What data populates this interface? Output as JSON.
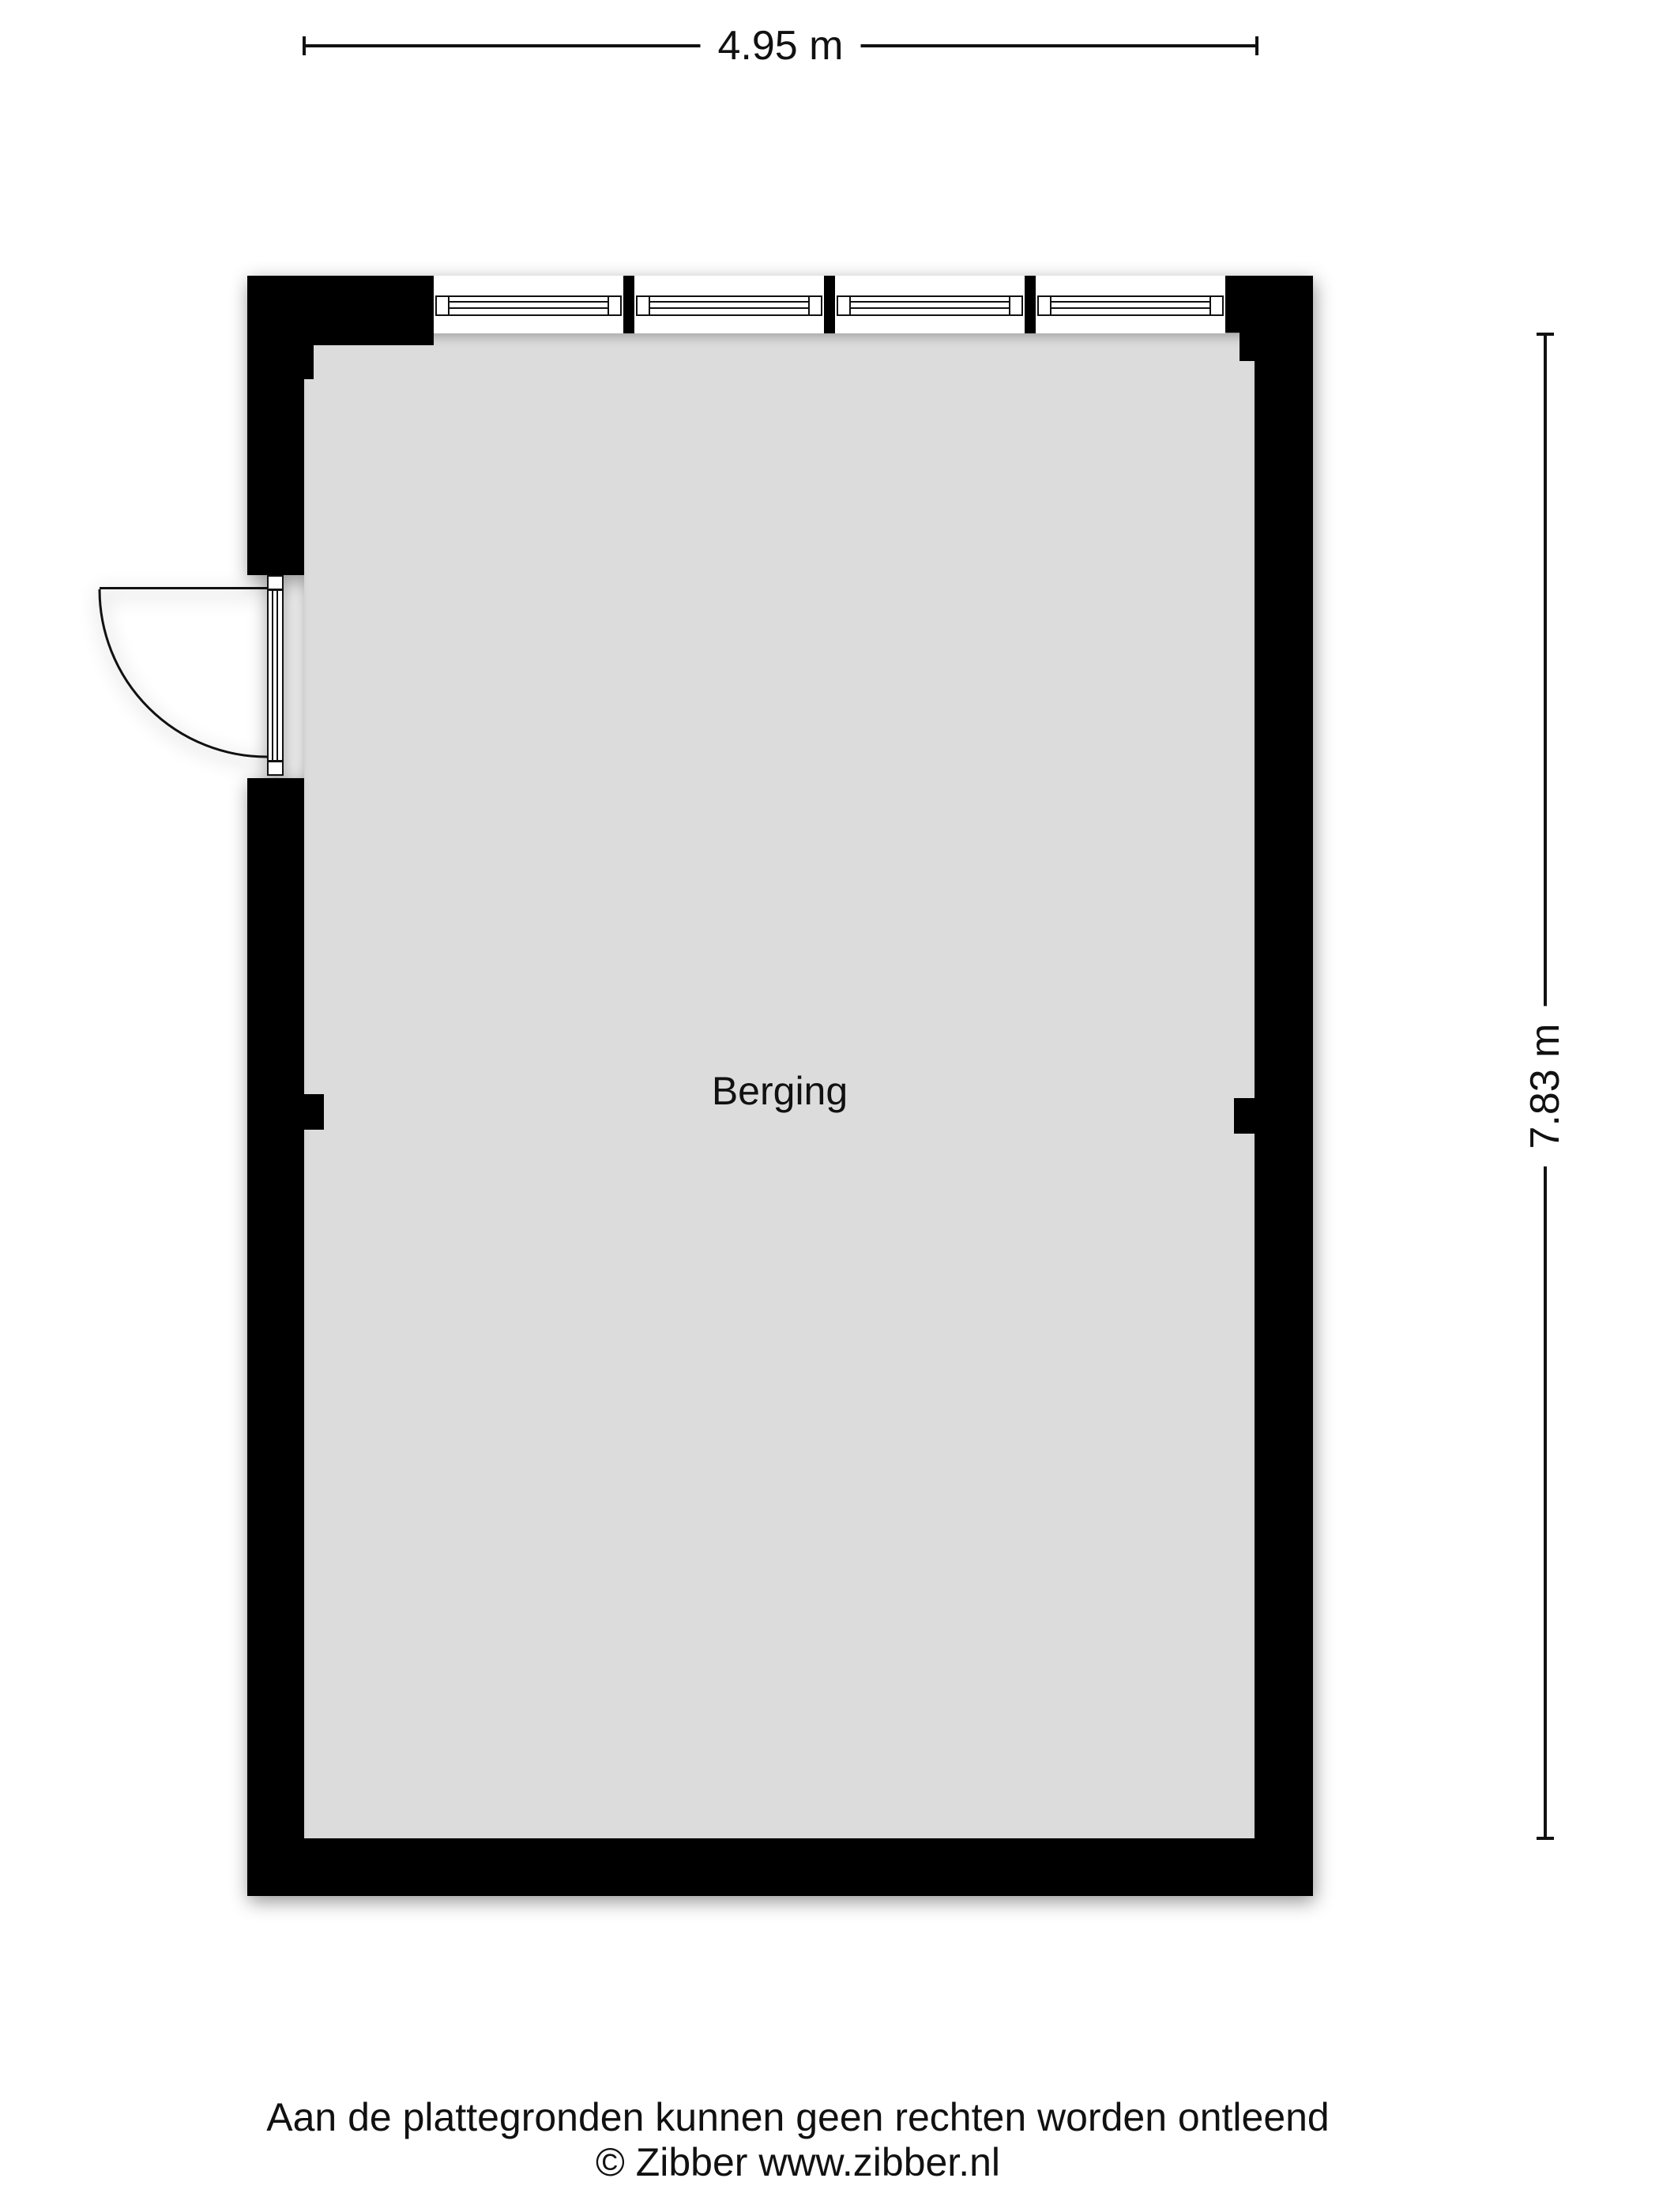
{
  "dimensions": {
    "width_label": "4.95 m",
    "height_label": "7.83 m"
  },
  "room": {
    "label": "Berging"
  },
  "footer": {
    "disclaimer": "Aan de plattegronden kunnen geen rechten worden ontleend",
    "copyright": "© Zibber www.zibber.nl"
  },
  "colors": {
    "wall": "#000000",
    "floor": "#dcdcdc",
    "line": "#111111",
    "text": "#111111",
    "background": "#ffffff"
  }
}
